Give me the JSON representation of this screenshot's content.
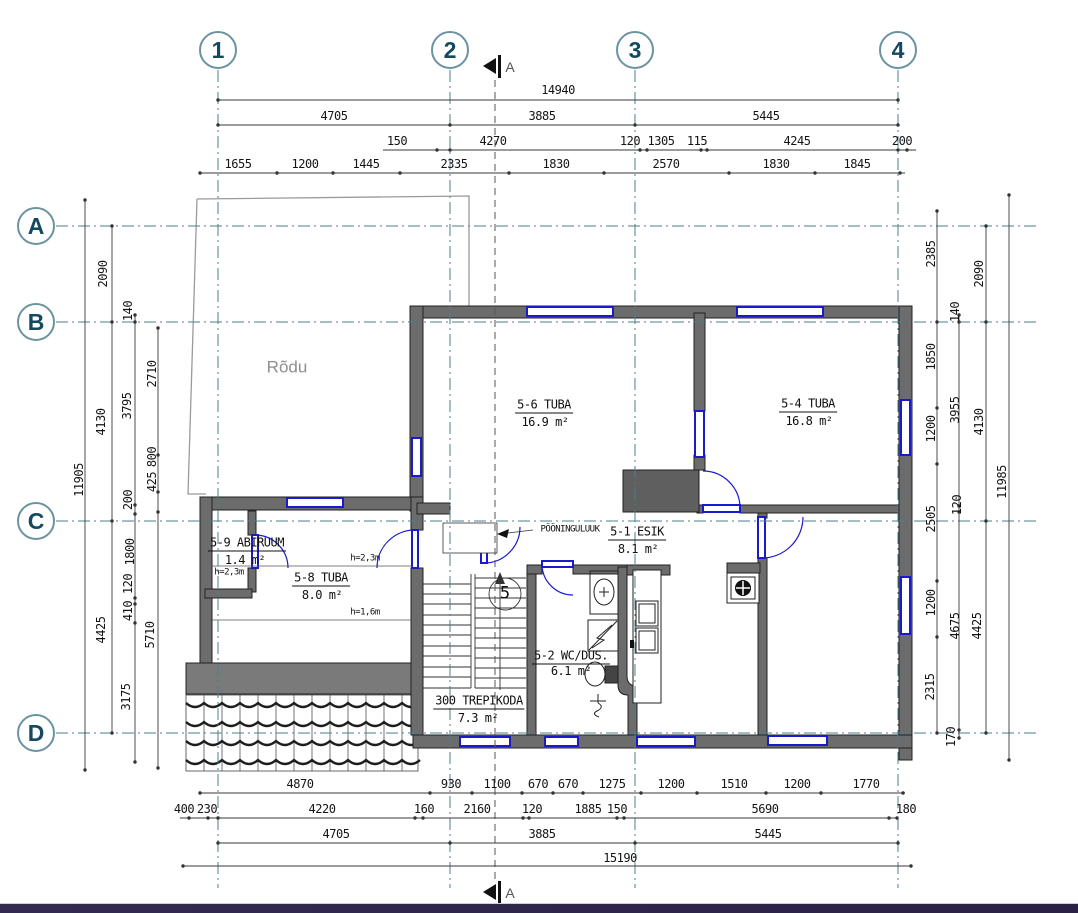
{
  "drawing": {
    "grid_cols": [
      {
        "t": "1",
        "x": 218,
        "y": 50
      },
      {
        "t": "2",
        "x": 450,
        "y": 50
      },
      {
        "t": "3",
        "x": 635,
        "y": 50
      },
      {
        "t": "4",
        "x": 898,
        "y": 50
      }
    ],
    "grid_rows": [
      {
        "t": "A",
        "x": 36,
        "y": 226
      },
      {
        "t": "B",
        "x": 36,
        "y": 322
      },
      {
        "t": "C",
        "x": 36,
        "y": 521
      },
      {
        "t": "D",
        "x": 36,
        "y": 733
      }
    ],
    "section_marks": [
      {
        "t": "A",
        "x": 510,
        "y": 67,
        "k": "sec"
      },
      {
        "t": "A",
        "x": 510,
        "y": 893,
        "k": "sec"
      }
    ],
    "dims_top": [
      {
        "t": "14940",
        "x": 558,
        "y": 90
      },
      {
        "t": "4705",
        "x": 334,
        "y": 116
      },
      {
        "t": "3885",
        "x": 542,
        "y": 116
      },
      {
        "t": "5445",
        "x": 766,
        "y": 116
      },
      {
        "t": "150",
        "x": 397,
        "y": 141
      },
      {
        "t": "4270",
        "x": 493,
        "y": 141
      },
      {
        "t": "120",
        "x": 630,
        "y": 141
      },
      {
        "t": "1305",
        "x": 661,
        "y": 141
      },
      {
        "t": "115",
        "x": 697,
        "y": 141
      },
      {
        "t": "4245",
        "x": 797,
        "y": 141
      },
      {
        "t": "200",
        "x": 902,
        "y": 141
      },
      {
        "t": "1655",
        "x": 238,
        "y": 164
      },
      {
        "t": "1200",
        "x": 305,
        "y": 164
      },
      {
        "t": "1445",
        "x": 366,
        "y": 164
      },
      {
        "t": "2335",
        "x": 454,
        "y": 164
      },
      {
        "t": "1830",
        "x": 556,
        "y": 164
      },
      {
        "t": "2570",
        "x": 666,
        "y": 164
      },
      {
        "t": "1830",
        "x": 776,
        "y": 164
      },
      {
        "t": "1845",
        "x": 857,
        "y": 164
      }
    ],
    "dims_bottom": [
      {
        "t": "4870",
        "x": 300,
        "y": 784
      },
      {
        "t": "930",
        "x": 451,
        "y": 784
      },
      {
        "t": "1100",
        "x": 497,
        "y": 784
      },
      {
        "t": "670",
        "x": 538,
        "y": 784
      },
      {
        "t": "670",
        "x": 568,
        "y": 784
      },
      {
        "t": "1275",
        "x": 612,
        "y": 784
      },
      {
        "t": "1200",
        "x": 671,
        "y": 784
      },
      {
        "t": "1510",
        "x": 734,
        "y": 784
      },
      {
        "t": "1200",
        "x": 797,
        "y": 784
      },
      {
        "t": "1770",
        "x": 866,
        "y": 784
      },
      {
        "t": "400",
        "x": 184,
        "y": 809
      },
      {
        "t": "230",
        "x": 207,
        "y": 809
      },
      {
        "t": "4220",
        "x": 322,
        "y": 809
      },
      {
        "t": "160",
        "x": 424,
        "y": 809
      },
      {
        "t": "2160",
        "x": 477,
        "y": 809
      },
      {
        "t": "120",
        "x": 532,
        "y": 809
      },
      {
        "t": "1885",
        "x": 588,
        "y": 809
      },
      {
        "t": "150",
        "x": 617,
        "y": 809
      },
      {
        "t": "5690",
        "x": 765,
        "y": 809
      },
      {
        "t": "180",
        "x": 906,
        "y": 809
      },
      {
        "t": "4705",
        "x": 336,
        "y": 834
      },
      {
        "t": "3885",
        "x": 542,
        "y": 834
      },
      {
        "t": "5445",
        "x": 768,
        "y": 834
      },
      {
        "t": "15190",
        "x": 620,
        "y": 858
      }
    ],
    "dims_left": [
      {
        "t": "11905",
        "x": 79,
        "y": 480,
        "r": 1
      },
      {
        "t": "2090",
        "x": 103,
        "y": 274,
        "r": 1
      },
      {
        "t": "4130",
        "x": 101,
        "y": 422,
        "r": 1
      },
      {
        "t": "4425",
        "x": 101,
        "y": 630,
        "r": 1
      },
      {
        "t": "140",
        "x": 128,
        "y": 311,
        "r": 1
      },
      {
        "t": "3795",
        "x": 127,
        "y": 406,
        "r": 1
      },
      {
        "t": "200",
        "x": 128,
        "y": 500,
        "r": 1
      },
      {
        "t": "1800",
        "x": 130,
        "y": 552,
        "r": 1
      },
      {
        "t": "120",
        "x": 128,
        "y": 584,
        "r": 1
      },
      {
        "t": "410",
        "x": 128,
        "y": 611,
        "r": 1
      },
      {
        "t": "3175",
        "x": 126,
        "y": 697,
        "r": 1
      },
      {
        "t": "2710",
        "x": 152,
        "y": 374,
        "r": 1
      },
      {
        "t": "800",
        "x": 152,
        "y": 457,
        "r": 1
      },
      {
        "t": "425",
        "x": 152,
        "y": 482,
        "r": 1
      },
      {
        "t": "5710",
        "x": 150,
        "y": 635,
        "r": 1
      }
    ],
    "dims_right": [
      {
        "t": "2385",
        "x": 931,
        "y": 254,
        "r": 1
      },
      {
        "t": "1850",
        "x": 931,
        "y": 357,
        "r": 1
      },
      {
        "t": "1200",
        "x": 931,
        "y": 429,
        "r": 1
      },
      {
        "t": "2505",
        "x": 931,
        "y": 519,
        "r": 1
      },
      {
        "t": "1200",
        "x": 931,
        "y": 603,
        "r": 1
      },
      {
        "t": "2315",
        "x": 930,
        "y": 687,
        "r": 1
      },
      {
        "t": "140",
        "x": 955,
        "y": 312,
        "r": 1
      },
      {
        "t": "3955",
        "x": 955,
        "y": 410,
        "r": 1
      },
      {
        "t": "120",
        "x": 957,
        "y": 505,
        "r": 1
      },
      {
        "t": "4675",
        "x": 955,
        "y": 626,
        "r": 1
      },
      {
        "t": "170",
        "x": 951,
        "y": 737,
        "r": 1
      },
      {
        "t": "2090",
        "x": 979,
        "y": 274,
        "r": 1
      },
      {
        "t": "4130",
        "x": 979,
        "y": 422,
        "r": 1
      },
      {
        "t": "4425",
        "x": 977,
        "y": 626,
        "r": 1
      },
      {
        "t": "11985",
        "x": 1002,
        "y": 482,
        "r": 1
      }
    ],
    "room_labels": [
      {
        "t": "5-6 TUBA",
        "x": 544,
        "y": 406,
        "u": 1
      },
      {
        "t": "16.9 m²",
        "x": 545,
        "y": 422
      },
      {
        "t": "5-4 TUBA",
        "x": 808,
        "y": 405,
        "u": 1
      },
      {
        "t": "16.8 m²",
        "x": 809,
        "y": 421
      },
      {
        "t": "5-9 ABIRUUM",
        "x": 247,
        "y": 544,
        "u": 1
      },
      {
        "t": "1.4 m²",
        "x": 245,
        "y": 560
      },
      {
        "t": "5-8 TUBA",
        "x": 321,
        "y": 579,
        "u": 1
      },
      {
        "t": "8.0 m²",
        "x": 322,
        "y": 595
      },
      {
        "t": "5-1 ESIK",
        "x": 637,
        "y": 533,
        "u": 1
      },
      {
        "t": "8.1 m²",
        "x": 638,
        "y": 549
      },
      {
        "t": "5-2 WC/DUS.",
        "x": 571,
        "y": 657,
        "u": 1
      },
      {
        "t": "6.1 m²",
        "x": 571,
        "y": 671
      },
      {
        "t": "300 TREPIKODA",
        "x": 479,
        "y": 702,
        "u": 1
      },
      {
        "t": "7.3 m²",
        "x": 478,
        "y": 718
      }
    ],
    "notes": [
      {
        "t": "PÖÖNINGULUUK",
        "x": 570,
        "y": 530,
        "k": "sm"
      },
      {
        "t": "h=2,3m",
        "x": 365,
        "y": 559,
        "k": "sm"
      },
      {
        "t": "h=2,3m",
        "x": 229,
        "y": 573,
        "k": "sm"
      },
      {
        "t": "h=1,6m",
        "x": 365,
        "y": 613,
        "k": "sm"
      },
      {
        "t": "Rõdu",
        "x": 287,
        "y": 367,
        "k": "rodu"
      },
      {
        "t": "5",
        "x": 505,
        "y": 594,
        "k": "stair"
      }
    ],
    "colors": {
      "wall_gray": "#6c6c6c",
      "window_door_blue": "#1a1acc",
      "grid_teal": "#4d7d8c",
      "bubble_text": "#15495e",
      "dimension_text": "#141414",
      "balcony_text": "#8f8f8f",
      "bottom_bar": "#2b2345"
    }
  }
}
